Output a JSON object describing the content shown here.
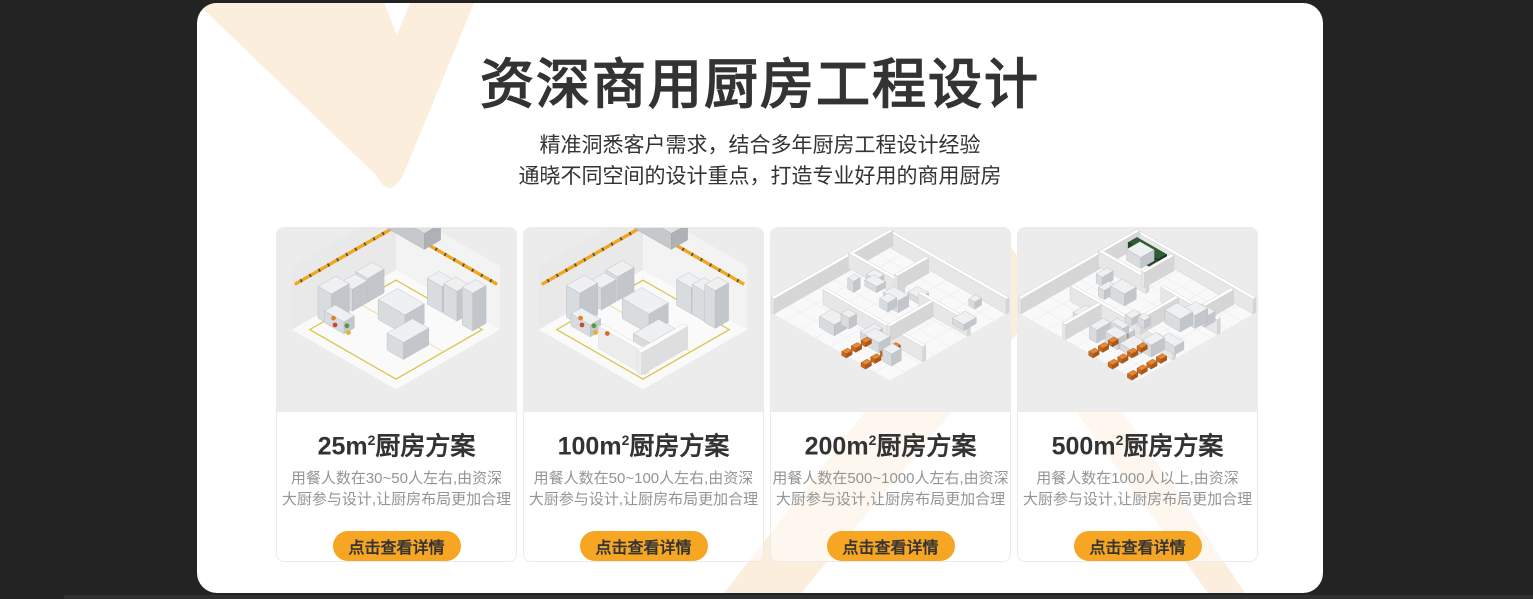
{
  "header": {
    "title": "资深商用厨房工程设计",
    "subtitle_lines": [
      "精准洞悉客户需求，结合多年厨房工程设计经验",
      "通晓不同空间的设计重点，打造专业好用的商用厨房"
    ]
  },
  "cards": [
    {
      "title_prefix": "25m",
      "title_sup": "2",
      "title_suffix": "厨房方案",
      "desc_lines": [
        "用餐人数在30~50人左右,由资深",
        "大厨参与设计,让厨房布局更加合理"
      ],
      "cta_label": "点击查看详情",
      "illustration": {
        "style": "corner",
        "seed": 7,
        "blocks": 9,
        "accents": 4,
        "halfWalls": false
      }
    },
    {
      "title_prefix": "100m",
      "title_sup": "2",
      "title_suffix": "厨房方案",
      "desc_lines": [
        "用餐人数在50~100人左右,由资深",
        "大厨参与设计,让厨房布局更加合理"
      ],
      "cta_label": "点击查看详情",
      "illustration": {
        "style": "corner",
        "seed": 13,
        "blocks": 9,
        "accents": 5,
        "halfWalls": true
      }
    },
    {
      "title_prefix": "200m",
      "title_sup": "2",
      "title_suffix": "厨房方案",
      "desc_lines": [
        "用餐人数在500~1000人左右,由资深",
        "大厨参与设计,让厨房布局更加合理"
      ],
      "cta_label": "点击查看详情",
      "illustration": {
        "style": "plan",
        "seed": 21,
        "blocks": 13,
        "rooms": 3,
        "benches": 2,
        "green": false
      }
    },
    {
      "title_prefix": "500m",
      "title_sup": "2",
      "title_suffix": "厨房方案",
      "desc_lines": [
        "用餐人数在1000人以上,由资深",
        "大厨参与设计,让厨房布局更加合理"
      ],
      "cta_label": "点击查看详情",
      "illustration": {
        "style": "plan",
        "seed": 33,
        "blocks": 17,
        "rooms": 4,
        "benches": 3,
        "green": true
      }
    }
  ],
  "colors": {
    "backdrop_dark": "#232323",
    "panel_white": "#ffffff",
    "decor_cream": "#fbeedc",
    "accent_orange": "#f6a623",
    "title_dark": "#333333",
    "desc_gray": "#949494"
  }
}
